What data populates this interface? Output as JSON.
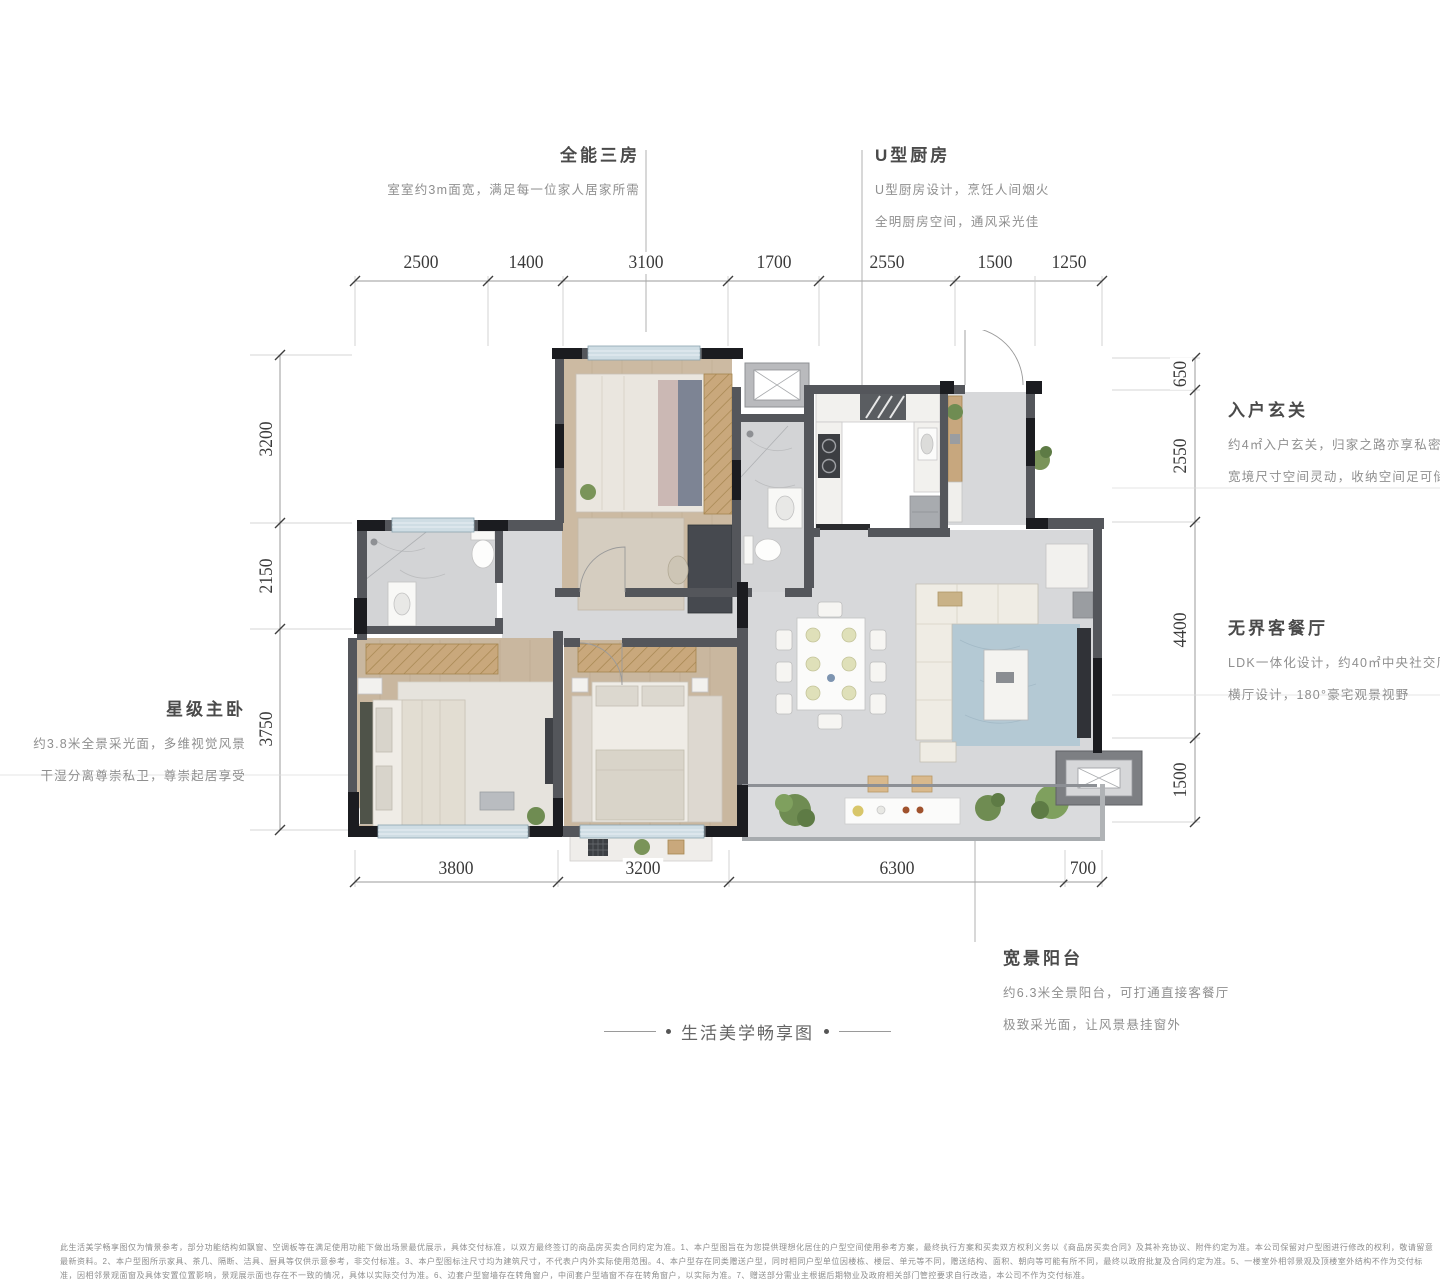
{
  "annotations": {
    "rooms_top_left": {
      "title": "全能三房",
      "desc": "室室约3m面宽，满足每一位家人居家所需"
    },
    "kitchen": {
      "title": "U型厨房",
      "desc1": "U型厨房设计，烹饪人间烟火",
      "desc2": "全明厨房空间，通风采光佳"
    },
    "entry": {
      "title": "入户玄关",
      "desc1": "约4㎡入户玄关，归家之路亦享私密",
      "desc2": "宽境尺寸空间灵动，收纳空间足可储"
    },
    "living": {
      "title": "无界客餐厅",
      "desc1": "LDK一体化设计，约40㎡中央社交厅",
      "desc2": "横厅设计，180°豪宅观景视野"
    },
    "master": {
      "title": "星级主卧",
      "desc1": "约3.8米全景采光面，多维视觉风景",
      "desc2": "干湿分离尊崇私卫，尊崇起居享受"
    },
    "balcony": {
      "title": "宽景阳台",
      "desc1": "约6.3米全景阳台，可打通直接客餐厅",
      "desc2": "极致采光面，让风景悬挂窗外"
    }
  },
  "caption": "生活美学畅享图",
  "dimensions": {
    "top": [
      "2500",
      "1400",
      "3100",
      "1700",
      "2550",
      "1500",
      "1250"
    ],
    "bottom": [
      "3800",
      "3200",
      "6300",
      "700"
    ],
    "left": [
      "3200",
      "2150",
      "3750"
    ],
    "right": [
      "650",
      "2550",
      "4400",
      "1500"
    ]
  },
  "disclaimer": "此生活美学畅享图仅为情景参考，部分功能结构如飘窗、空调板等在满足使用功能下做出场景最优展示，具体交付标准，以双方最终签订的商品房买卖合同约定为准。1、本户型图旨在为您提供理想化居住的户型空间使用参考方案，最终执行方案和买卖双方权利义务以《商品房买卖合同》及其补充协议、附件约定为准。本公司保留对户型图进行修改的权利，敬请留意最新资料。2、本户型图所示家具、茶几、隔断、洁具、厨具等仅供示意参考，非交付标准。3、本户型图标注尺寸均为建筑尺寸，不代表户内外实际使用范围。4、本户型存在同类赠送户型，同时相同户型单位因楼栋、楼层、单元等不同，赠送结构、面积、朝向等可能有所不同，最终以政府批复及合同约定为准。5、一楼室外相邻景观及顶楼室外结构不作为交付标准，因相邻景观面窗及具体安置位置影响，景观展示面也存在不一致的情况，具体以实际交付为准。6、边套户型窗墙存在转角窗户，中间套户型墙窗不存在转角窗户，以实际为准。7、赠送部分需业主根据后期物业及政府相关部门管控要求自行改造，本公司不作为交付标准。",
  "colors": {
    "wall": "#54565b",
    "wall_dark": "#1b1c20",
    "window": "#cfdde4",
    "tile": "#d7d8da",
    "wood": "#c9b79f",
    "rug_blue": "#b4c9d4",
    "title_text": "#4a4a4a",
    "desc_text": "#8f8f8f",
    "dim_text": "#3a3a3a"
  }
}
